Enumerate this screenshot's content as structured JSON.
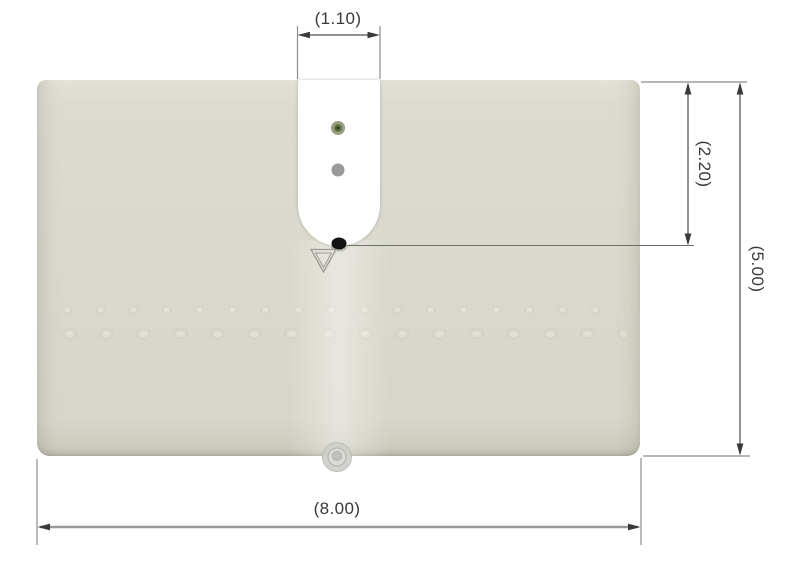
{
  "drawing": {
    "type": "technical-dimension-drawing",
    "dimensions": {
      "slot_width_label": "(1.10)",
      "slot_depth_label": "(2.20)",
      "plate_height_label": "(5.00)",
      "plate_width_label": "(8.00)"
    },
    "colors": {
      "plate_fill": "#dad9cd",
      "slot_fill": "#ffffff",
      "dimension_line": "#838383",
      "extension_line": "#8c8c8c",
      "arrow": "#3a3a3a",
      "label_text": "#39393b",
      "indicator_green_outer": "#99a07f",
      "indicator_green_inner": "#5d6c41",
      "indicator_gray": "#9a9a9a",
      "probe_dot": "#141414",
      "datum_triangle": "#9c9c94",
      "grommet": "#cfcfca"
    }
  }
}
